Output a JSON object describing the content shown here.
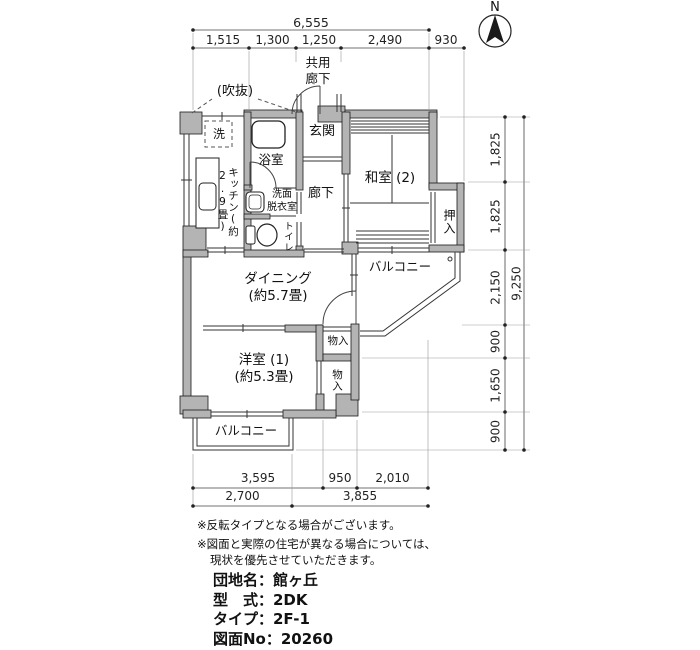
{
  "north_label": "N",
  "dimensions": {
    "top": {
      "total": "6,555",
      "segments": [
        "1,515",
        "1,300",
        "1,250",
        "2,490",
        "930"
      ]
    },
    "right": {
      "total": "9,250",
      "segments": [
        "1,825",
        "1,825",
        "2,150",
        "900",
        "1,650",
        "900"
      ]
    },
    "bottom": {
      "row1": [
        "3,595",
        "950",
        "2,010"
      ],
      "row2": [
        "2,700",
        "3,855"
      ]
    }
  },
  "rooms": {
    "common_corridor": "共用\n廊下",
    "void_space": "(吹抜)",
    "washer": "洗",
    "kitchen": "キッチン(約2.9畳)",
    "bathroom": "浴室",
    "entrance": "玄関",
    "washroom": "洗面\n脱衣室",
    "toilet": "トイレ",
    "hallway": "廊下",
    "japanese_room": "和室 (2)",
    "oshiire": "押入",
    "balcony_right": "バルコニー",
    "dining": "ダイニング\n(約5.7畳)",
    "storage_upper": "物入",
    "storage_lower": "物入",
    "western_room": "洋室 (1)\n(約5.3畳)",
    "balcony_bottom": "バルコニー"
  },
  "notes": {
    "line1": "※反転タイプとなる場合がございます。",
    "line2": "※図面と実際の住宅が異なる場合については、",
    "line3": "現状を優先させていただきます。"
  },
  "info": {
    "line1": "団地名：館ヶ丘",
    "line2": "型　式：2DK",
    "line3": "タイプ：2F-1",
    "line4": "図面No：20260"
  }
}
